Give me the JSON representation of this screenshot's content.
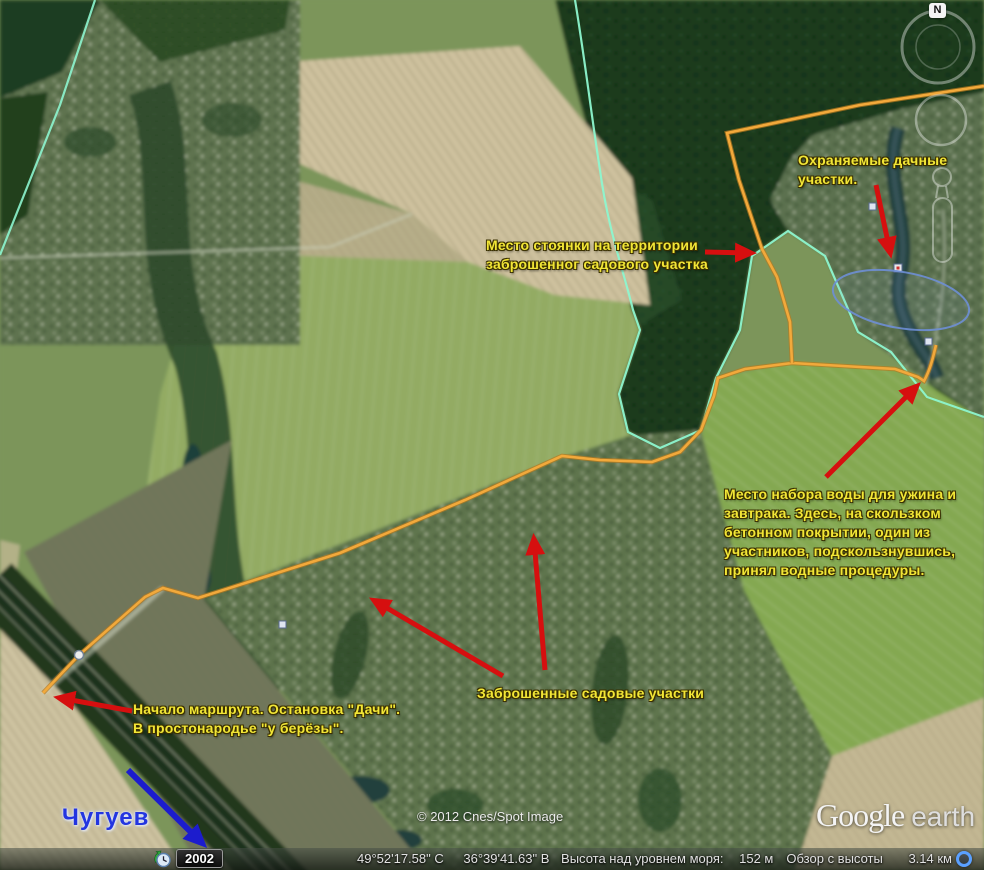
{
  "map": {
    "annotations": {
      "protected_dachas": "Охраняемые дачные\nучастки.",
      "camp_site": "Место стоянки на территории\nзаброшенног садового участка",
      "water_point": "Место набора воды для ужина и\nзавтрака. Здесь, на скользком\nбетонном покрытии, один из\nучастников, подскользнувшись,\nпринял водные процедуры.",
      "abandoned_gardens": "Заброшенные садовые участки",
      "route_start": "Начало маршрута. Остановка \"Дачи\".\nВ простонародье \"у берёзы\".",
      "town": "Чугуев"
    },
    "copyright": "© 2012 Cnes/Spot Image",
    "logo": {
      "brand": "Google",
      "product": "earth"
    },
    "compass_north": "N",
    "colors": {
      "route": "#f2a93b",
      "boundary": "#8df5cf",
      "annotation": "#f2e636",
      "arrow": "#d60f0f",
      "town_label": "#2335e0"
    }
  },
  "timeline": {
    "year": "2002"
  },
  "status_bar": {
    "latitude": "49°52'17.58\" С",
    "longitude": "36°39'41.63\" В",
    "elevation_label": "Высота над уровнем моря:",
    "elevation_value": "152 м",
    "eye_alt_label": "Обзор с высоты",
    "eye_alt_value": "3.14 км"
  }
}
